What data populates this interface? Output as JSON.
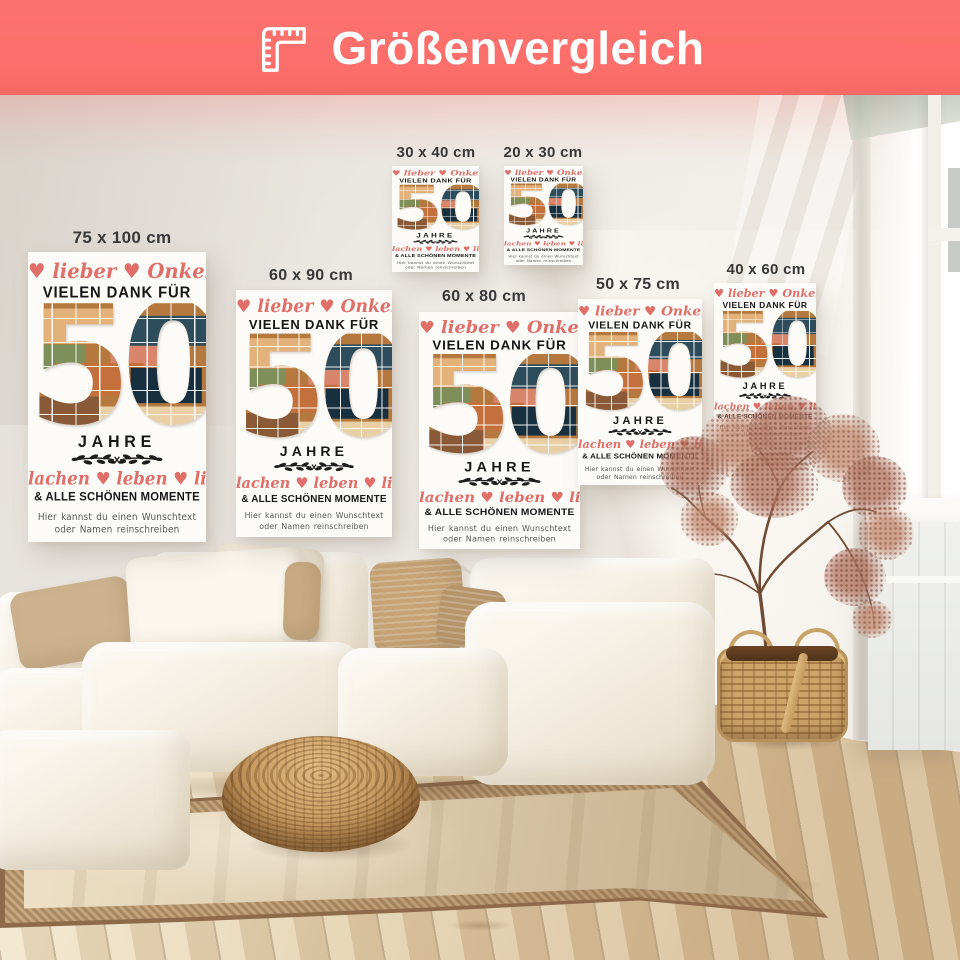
{
  "header": {
    "title": "Größenvergleich",
    "icon": "ruler-icon",
    "background": "#fc6e6a"
  },
  "poster_design": {
    "accent_color": "#df6f68",
    "script_top": "♥ lieber ♥ Onkel ♥",
    "thanks_line": "VIELEN DANK FÜR",
    "big_number": "50",
    "years_line": "JAHRE",
    "script_bottom": "lachen ♥ leben ♥ lieben",
    "moments_line": "& ALLE SCHÖNEN MOMENTE",
    "wish_line1": "Hier kannst du einen Wunschtext",
    "wish_line2": "oder Namen reinschreiben"
  },
  "posters": [
    {
      "label": "75 x 100 cm",
      "x": 28,
      "y": 252,
      "w": 178,
      "h": 290,
      "label_cx": 122,
      "label_y": 228,
      "label_fs": 17
    },
    {
      "label": "60 x 90 cm",
      "x": 236,
      "y": 290,
      "w": 156,
      "h": 247,
      "label_cx": 311,
      "label_y": 267,
      "label_fs": 16
    },
    {
      "label": "30 x 40 cm",
      "x": 392,
      "y": 166,
      "w": 87,
      "h": 106,
      "label_cx": 436,
      "label_y": 144,
      "label_fs": 15
    },
    {
      "label": "20 x 30 cm",
      "x": 504,
      "y": 166,
      "w": 79,
      "h": 99,
      "label_cx": 543,
      "label_y": 144,
      "label_fs": 15
    },
    {
      "label": "60 x 80 cm",
      "x": 419,
      "y": 312,
      "w": 161,
      "h": 237,
      "label_cx": 484,
      "label_y": 288,
      "label_fs": 16
    },
    {
      "label": "50 x 75 cm",
      "x": 578,
      "y": 299,
      "w": 124,
      "h": 186,
      "label_cx": 638,
      "label_y": 276,
      "label_fs": 16
    },
    {
      "label": "40 x 60 cm",
      "x": 714,
      "y": 283,
      "w": 102,
      "h": 158,
      "label_cx": 766,
      "label_y": 261,
      "label_fs": 15
    }
  ],
  "colors": {
    "wall": "#eae7e3",
    "poster_bg": "#fcfbf8",
    "label_text": "#383838",
    "text_black": "#161616",
    "handwriting_gray": "#575757",
    "rug_border": "#8d6b4a",
    "rug_field": "#dbc9ab",
    "floor_wood": "#ddc7a4",
    "sofa_cream": "#f5f0e6",
    "wicker_tan": "#c79a5f",
    "dried_plant": "#b3786a"
  }
}
